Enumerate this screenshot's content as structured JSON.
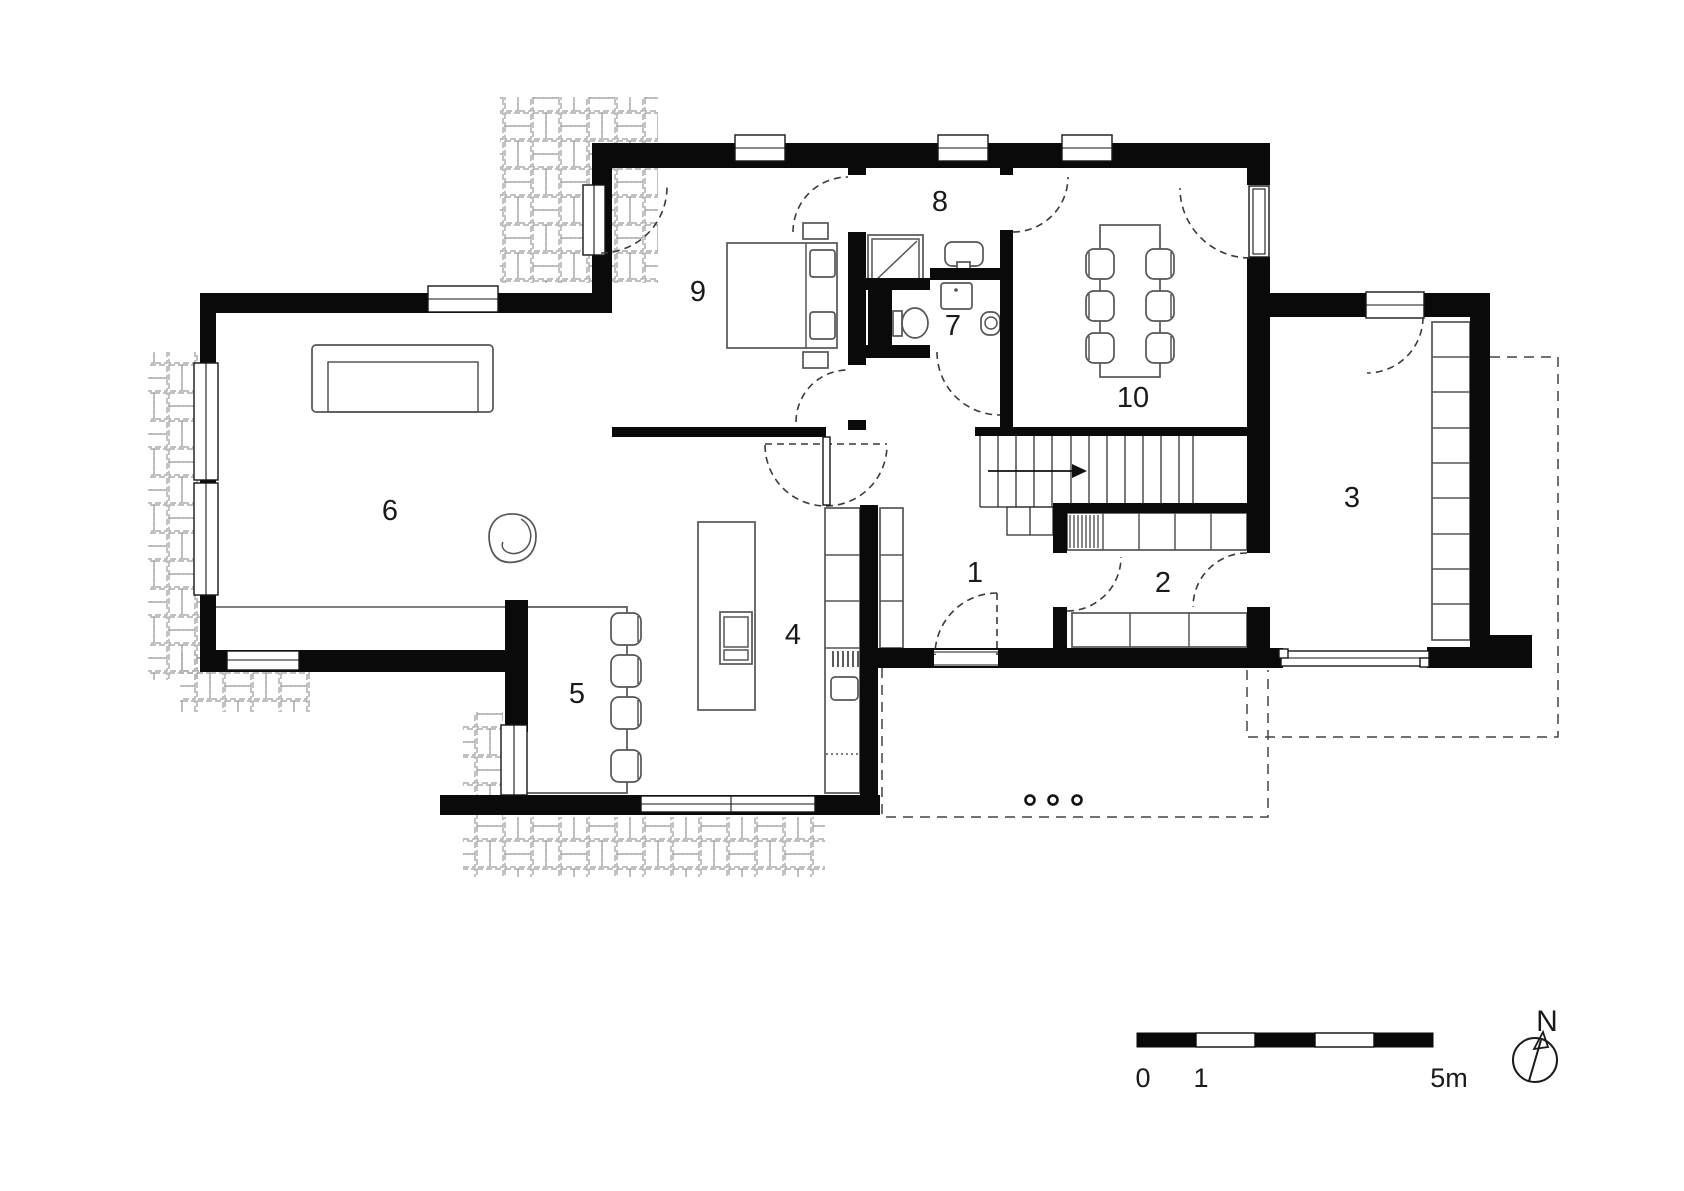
{
  "plan": {
    "rooms": [
      {
        "number": "1"
      },
      {
        "number": "2"
      },
      {
        "number": "3"
      },
      {
        "number": "4"
      },
      {
        "number": "5"
      },
      {
        "number": "6"
      },
      {
        "number": "7"
      },
      {
        "number": "8"
      },
      {
        "number": "9"
      },
      {
        "number": "10"
      }
    ],
    "scale_bar": {
      "labels": [
        "0",
        "1",
        "5m"
      ]
    },
    "north": {
      "label": "N"
    },
    "colors": {
      "background": "#ffffff",
      "wall": "#0a0a0a",
      "furniture": "#555555",
      "hatch": "#9a9a9a",
      "door": "#3a3a3a",
      "line": "#333333",
      "text": "#1a1a1a"
    }
  }
}
